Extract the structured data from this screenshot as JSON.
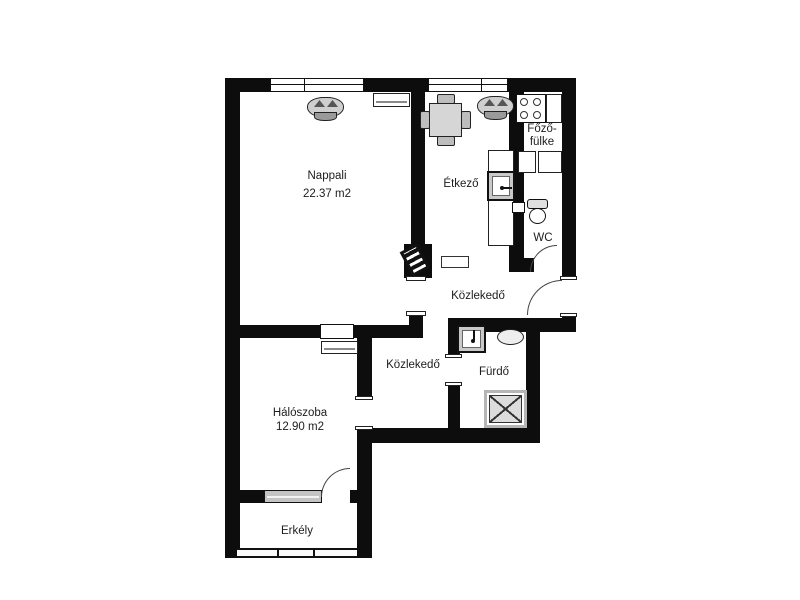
{
  "floorplan": {
    "rooms": {
      "nappali": {
        "name": "Nappali",
        "area": "22.37 m2"
      },
      "etkezo": {
        "name": "Étkező"
      },
      "fozofulke": {
        "line1": "Főző-",
        "line2": "fülke"
      },
      "wc": {
        "name": "WC"
      },
      "kozlekedo_felso": {
        "name": "Közlekedő"
      },
      "kozlekedo_also": {
        "name": "Közlekedő"
      },
      "furdo": {
        "name": "Fürdő"
      },
      "haloszoba": {
        "name": "Hálószoba",
        "area": "12.90 m2"
      },
      "erkely": {
        "name": "Erkély"
      }
    },
    "colors": {
      "wall": "#0d0d0d",
      "background": "#ffffff",
      "fixture_gray": "#d6d6d6",
      "door_arc": "#444444"
    }
  }
}
